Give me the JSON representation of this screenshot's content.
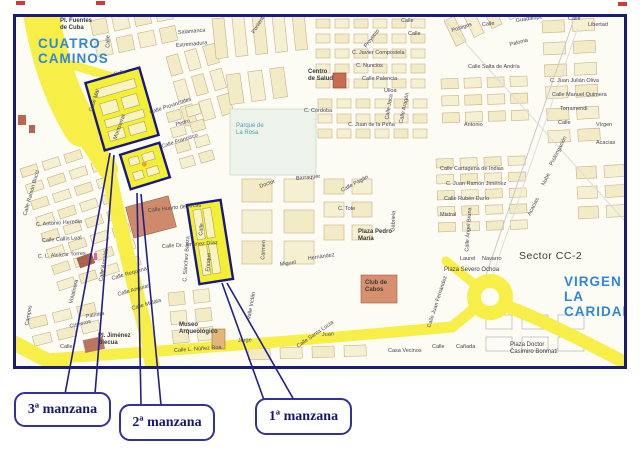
{
  "callouts": [
    {
      "label": "3ª manzana"
    },
    {
      "label": "2ª manzana"
    },
    {
      "label": "1ª manzana"
    }
  ],
  "map": {
    "area_labels": [
      {
        "name": "district-cuatro-caminos",
        "cls": "city",
        "text": "CUATRO\nCAMINOS",
        "x": 22,
        "y": 20
      },
      {
        "name": "district-virgen-la-caridad",
        "cls": "city",
        "text": "VIRGEN\nLA CARIDAD",
        "x": 548,
        "y": 258
      },
      {
        "name": "sector-cc-2",
        "cls": "sector",
        "text": "Sector CC-2",
        "x": 503,
        "y": 233
      },
      {
        "name": "parque-de-la-rosa",
        "cls": "park",
        "text": "Parque de\nLa Rosa",
        "x": 220,
        "y": 106
      },
      {
        "name": "pl-fuentes-de-cuba",
        "cls": "place",
        "text": "Pl. Fuentes\nde Cuba",
        "x": 44,
        "y": 1
      },
      {
        "name": "centro-de-salud",
        "cls": "place",
        "text": "Centro\nde Salud",
        "x": 292,
        "y": 52
      },
      {
        "name": "plaza-pedro-maria",
        "cls": "place",
        "text": "Plaza Pedro\nMaría",
        "x": 342,
        "y": 212
      },
      {
        "name": "club-de-cabos",
        "cls": "place",
        "text": "Club de\nCabos",
        "x": 349,
        "y": 263
      },
      {
        "name": "museo-arqueologico",
        "cls": "place",
        "text": "Museo\nArqueológico",
        "x": 163,
        "y": 305
      },
      {
        "name": "pl-jimenez-blecua",
        "cls": "place",
        "text": "Pl. Jiménez\nBlecua",
        "x": 82,
        "y": 316
      },
      {
        "name": "plaza-severo-ochoa",
        "cls": "plaza",
        "text": "Plaza Severo Ochoa",
        "x": 428,
        "y": 250
      },
      {
        "name": "plaza-doctor-casimiro-bonmati",
        "cls": "plaza",
        "text": "Plaza Doctor\nCasimiro Bonmatí",
        "x": 494,
        "y": 325
      }
    ],
    "streets": [
      {
        "t": "Calle",
        "x": 93,
        "y": 28,
        "r": -90
      },
      {
        "t": "Salamanca",
        "x": 162,
        "y": 14,
        "r": -5
      },
      {
        "t": "Extremadura",
        "x": 160,
        "y": 27,
        "r": -5
      },
      {
        "t": "Poniente",
        "x": 238,
        "y": 14,
        "r": -58
      },
      {
        "t": "Calle",
        "x": 385,
        "y": 2,
        "r": 0
      },
      {
        "t": "Calle",
        "x": 392,
        "y": 15,
        "r": 0
      },
      {
        "t": "Proyecto",
        "x": 350,
        "y": 28,
        "r": -52
      },
      {
        "t": "Postigos",
        "x": 436,
        "y": 12,
        "r": -18
      },
      {
        "t": "Calle",
        "x": 466,
        "y": 6,
        "r": -5
      },
      {
        "t": "Guadalupe",
        "x": 500,
        "y": 2,
        "r": -8
      },
      {
        "t": "Paloma",
        "x": 494,
        "y": 26,
        "r": -14
      },
      {
        "t": "Libertad",
        "x": 572,
        "y": 6,
        "r": 0
      },
      {
        "t": "Calle",
        "x": 552,
        "y": 0,
        "r": 0
      },
      {
        "t": "Antonio",
        "x": 448,
        "y": 106,
        "r": 0
      },
      {
        "t": "Calle Provinciales",
        "x": 134,
        "y": 94,
        "r": -18
      },
      {
        "t": "Pedro",
        "x": 160,
        "y": 106,
        "r": -15
      },
      {
        "t": "Calle Francisco",
        "x": 146,
        "y": 128,
        "r": -18
      },
      {
        "t": "Calle Mar",
        "x": 76,
        "y": 92,
        "r": -72
      },
      {
        "t": "Montserrat",
        "x": 100,
        "y": 120,
        "r": -70
      },
      {
        "t": "Calle",
        "x": 98,
        "y": 56,
        "r": -14
      },
      {
        "t": "C. Javier Compostela",
        "x": 336,
        "y": 34,
        "r": 0
      },
      {
        "t": "C. Nuncios",
        "x": 340,
        "y": 47,
        "r": 0
      },
      {
        "t": "Calle Palencia",
        "x": 346,
        "y": 60,
        "r": 0
      },
      {
        "t": "C. Córdoba",
        "x": 288,
        "y": 92,
        "r": 0
      },
      {
        "t": "C. Juan de la Peña",
        "x": 332,
        "y": 106,
        "r": 0
      },
      {
        "t": "Ulloa",
        "x": 368,
        "y": 72,
        "r": 0
      },
      {
        "t": "Calle Jaca",
        "x": 372,
        "y": 100,
        "r": -80
      },
      {
        "t": "Calle Aragón",
        "x": 386,
        "y": 104,
        "r": -78
      },
      {
        "t": "Calle Salta de Andría",
        "x": 452,
        "y": 48,
        "r": 0
      },
      {
        "t": "C. Juan Julián Oliva",
        "x": 534,
        "y": 62,
        "r": 0
      },
      {
        "t": "Calle Manuel Quimera",
        "x": 536,
        "y": 76,
        "r": 0
      },
      {
        "t": "Torramendi",
        "x": 544,
        "y": 90,
        "r": 0
      },
      {
        "t": "Calle",
        "x": 542,
        "y": 104,
        "r": 0
      },
      {
        "t": "Vírgen",
        "x": 580,
        "y": 106,
        "r": 0
      },
      {
        "t": "Acacias",
        "x": 580,
        "y": 124,
        "r": 0
      },
      {
        "t": "Calle Cartagena de Indias",
        "x": 424,
        "y": 150,
        "r": 0
      },
      {
        "t": "C. Juan Ramón Jiménez",
        "x": 430,
        "y": 165,
        "r": 0
      },
      {
        "t": "Calle Rubén Darío",
        "x": 428,
        "y": 180,
        "r": 0
      },
      {
        "t": "Mistral",
        "x": 424,
        "y": 196,
        "r": 0
      },
      {
        "t": "Laurel",
        "x": 444,
        "y": 240,
        "r": 0
      },
      {
        "t": "Navarro",
        "x": 466,
        "y": 240,
        "r": 0
      },
      {
        "t": "Calle Ángel Bruna",
        "x": 452,
        "y": 232,
        "r": -86
      },
      {
        "t": "Prolongación",
        "x": 536,
        "y": 146,
        "r": -63
      },
      {
        "t": "Nube",
        "x": 528,
        "y": 166,
        "r": -63
      },
      {
        "t": "Acacias",
        "x": 514,
        "y": 196,
        "r": -63
      },
      {
        "t": "Gabriela",
        "x": 378,
        "y": 212,
        "r": -87
      },
      {
        "t": "Carmen",
        "x": 248,
        "y": 240,
        "r": -87
      },
      {
        "t": "Miguel",
        "x": 264,
        "y": 246,
        "r": -8
      },
      {
        "t": "Hernández",
        "x": 292,
        "y": 240,
        "r": -8
      },
      {
        "t": "Barraquer",
        "x": 280,
        "y": 160,
        "r": -5
      },
      {
        "t": "Doctor",
        "x": 244,
        "y": 168,
        "r": -20
      },
      {
        "t": "C. Tote",
        "x": 322,
        "y": 190,
        "r": 0
      },
      {
        "t": "Calle Pagán",
        "x": 326,
        "y": 172,
        "r": -28
      },
      {
        "t": "Calle Huerto de Arcas",
        "x": 132,
        "y": 192,
        "r": -6
      },
      {
        "t": "Calle Dr. Jiménez Díaz",
        "x": 146,
        "y": 228,
        "r": -4
      },
      {
        "t": "Calle",
        "x": 186,
        "y": 216,
        "r": -86
      },
      {
        "t": "Enrique",
        "x": 193,
        "y": 252,
        "r": -86
      },
      {
        "t": "C. Sánchez Baeza",
        "x": 170,
        "y": 262,
        "r": -86
      },
      {
        "t": "Calle Ramón Bucci",
        "x": 10,
        "y": 196,
        "r": -74
      },
      {
        "t": "C. Antonio Heredia",
        "x": 20,
        "y": 206,
        "r": -4
      },
      {
        "t": "Calle Callís Leal",
        "x": 26,
        "y": 222,
        "r": -4
      },
      {
        "t": "C. L. Alcázar Torres",
        "x": 22,
        "y": 238,
        "r": -4
      },
      {
        "t": "Volatinera",
        "x": 56,
        "y": 284,
        "r": -76
      },
      {
        "t": "Calle Ansaldo",
        "x": 86,
        "y": 262,
        "r": -80
      },
      {
        "t": "Calle Requena",
        "x": 96,
        "y": 260,
        "r": -16
      },
      {
        "t": "Calle Anguiar",
        "x": 102,
        "y": 276,
        "r": -16
      },
      {
        "t": "Calle Mulata",
        "x": 116,
        "y": 290,
        "r": -16
      },
      {
        "t": "Palmira",
        "x": 70,
        "y": 298,
        "r": -10
      },
      {
        "t": "Campos",
        "x": 12,
        "y": 306,
        "r": -80
      },
      {
        "t": "Cisneros",
        "x": 54,
        "y": 308,
        "r": -14
      },
      {
        "t": "Calle",
        "x": 44,
        "y": 328,
        "r": 0
      },
      {
        "t": "Jorge",
        "x": 222,
        "y": 322,
        "r": -3
      },
      {
        "t": "Juan",
        "x": 306,
        "y": 316,
        "r": -3
      },
      {
        "t": "Calle Juan Fernández",
        "x": 414,
        "y": 308,
        "r": -72
      },
      {
        "t": "Valle Inclán",
        "x": 234,
        "y": 300,
        "r": -80
      },
      {
        "t": "Calle Santa Lucía",
        "x": 282,
        "y": 328,
        "r": -35
      },
      {
        "t": "Calle L. Núñez Roa",
        "x": 158,
        "y": 332,
        "r": -4
      },
      {
        "t": "Casa Vecinos",
        "x": 372,
        "y": 332,
        "r": 0
      },
      {
        "t": "Cañada",
        "x": 440,
        "y": 328,
        "r": 0
      },
      {
        "t": "Calle",
        "x": 416,
        "y": 328,
        "r": 0
      }
    ]
  },
  "colors": {
    "map_border": "#1b1b7c",
    "road_yellow": "#f7ef47",
    "highlight_yellow": "#f3ef35",
    "highlight_border": "#181880",
    "block_cream": "#f3ebc6",
    "city_blue": "#2f87d8",
    "callout_ink": "#17176b",
    "building_salmon": "#cf8a6c",
    "building_red": "#b06050"
  }
}
